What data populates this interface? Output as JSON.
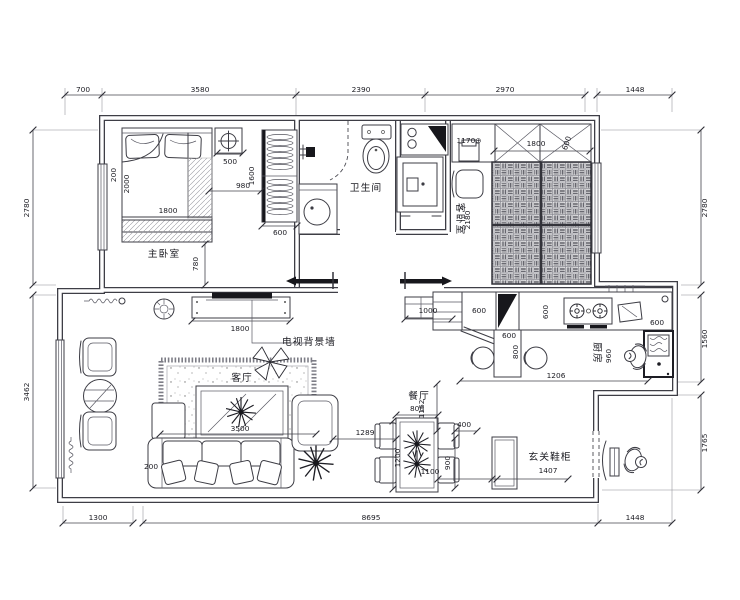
{
  "rooms": {
    "master": "主卧室",
    "bath": "卫生间",
    "guest": "客卧室",
    "living": "客厅",
    "dining": "餐厅",
    "kitchen": "厨房",
    "entry": "玄关鞋柜",
    "tv_wall": "电视背景墙"
  },
  "outer": {
    "top": [
      "700",
      "3580",
      "2390",
      "2970",
      "1448"
    ],
    "left": [
      "2780",
      "3462"
    ],
    "right": [
      "2780",
      "1560",
      "1765"
    ],
    "bottom": [
      "1300",
      "8695",
      "1448"
    ]
  },
  "master": {
    "w200": "200",
    "w2000": "2000",
    "bed": "1800",
    "lamp": "500",
    "gap": "980",
    "ward_h": "1600",
    "ward_w": "600",
    "door": "780"
  },
  "guest": {
    "counter": "1170⊕",
    "ward": "1800",
    "ward_d": "600",
    "depth": "2180"
  },
  "living": {
    "tv": "1800",
    "cabinet": "1000",
    "rug": "3500",
    "gap": "200",
    "sofa_gap": "1289"
  },
  "dining": {
    "w": "800",
    "l": "1200",
    "gap": "1100",
    "cab_h": "900",
    "cab_w": "400",
    "pass": "1162",
    "shoe": "1407"
  },
  "kitchen": {
    "c1": "600",
    "c2": "600",
    "c3": "600",
    "c4": "600",
    "bar": "800",
    "len": "1206",
    "depth": "960"
  }
}
